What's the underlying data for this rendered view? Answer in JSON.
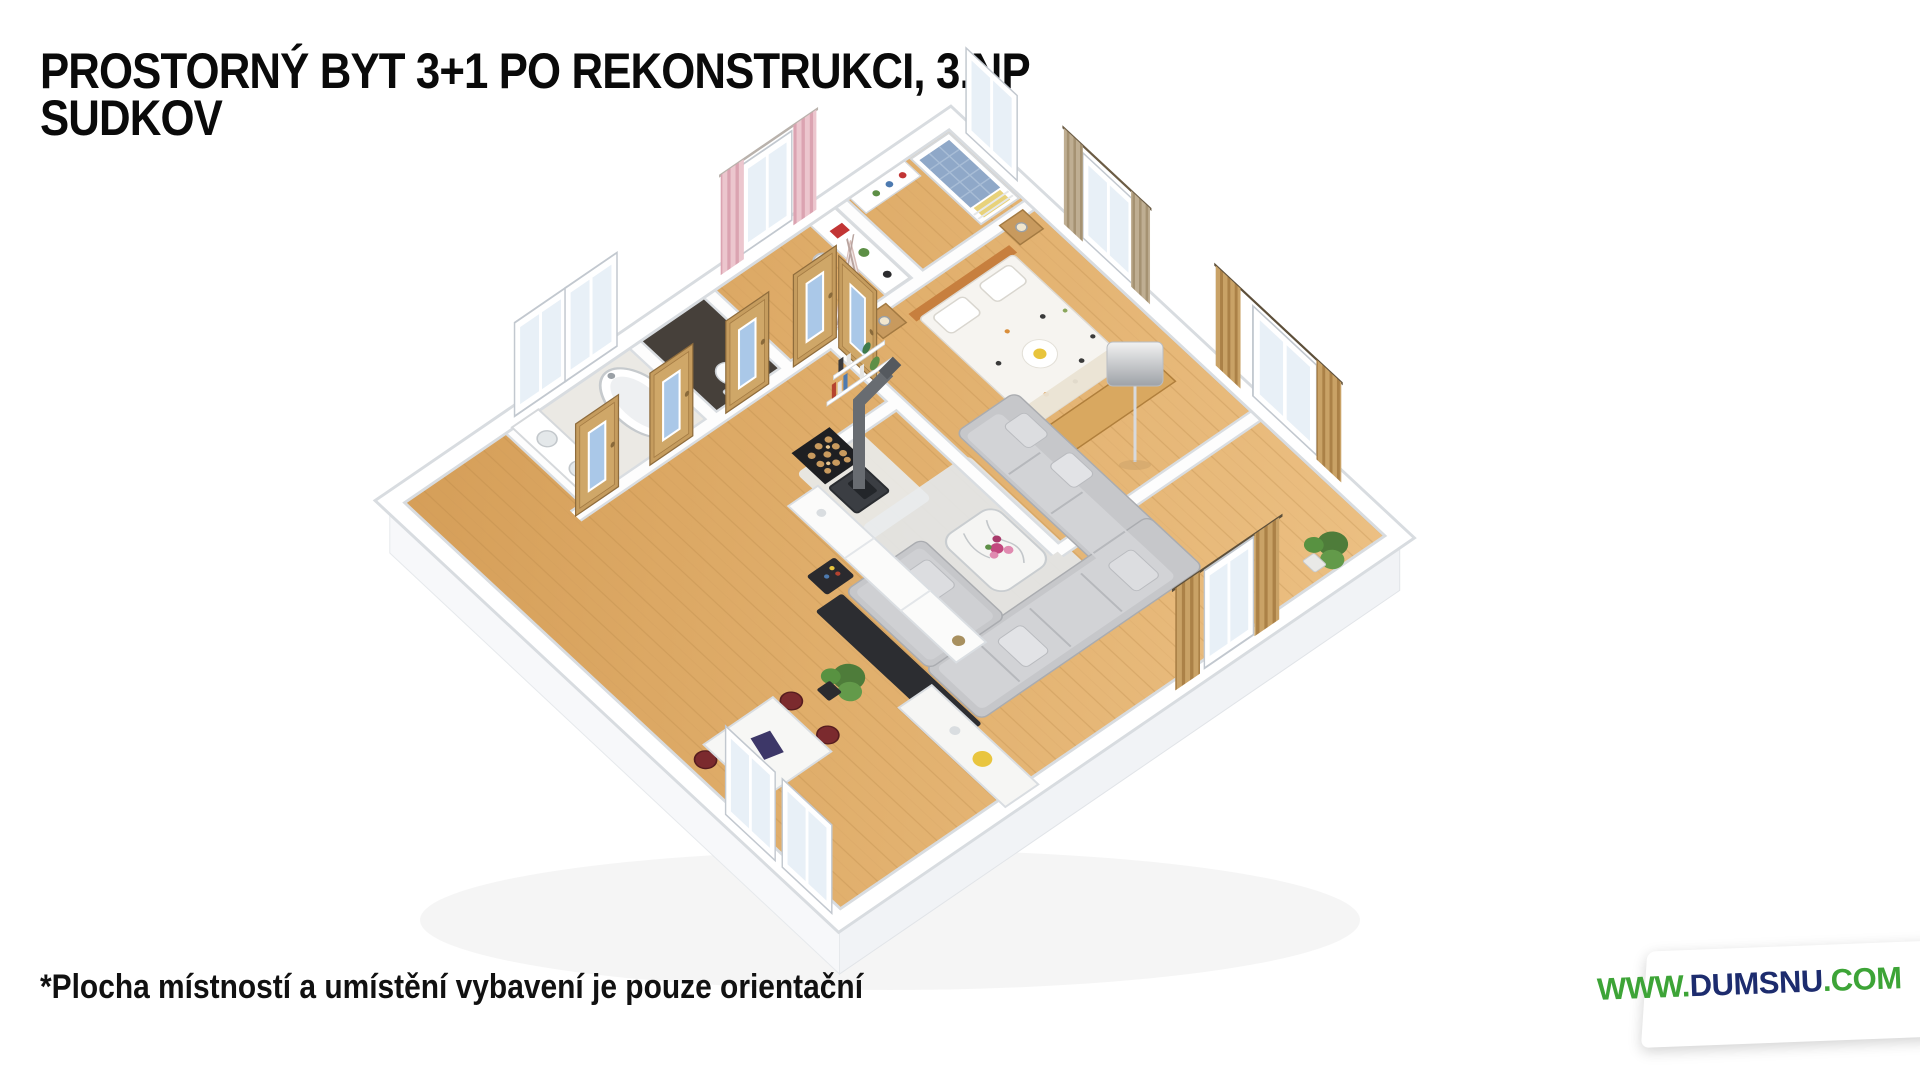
{
  "title": {
    "line1": "PROSTORNÝ BYT 3+1 PO REKONSTRUKCI, 3.NP",
    "line2": "SUDKOV"
  },
  "disclaimer": "*Plocha místností a umístění vybavení je pouze orientační",
  "watermark": {
    "prefix": "WWW.",
    "name": "DUMSNU",
    "suffix": ".COM",
    "prefix_color": "#3da437",
    "name_color": "#1d2c6e",
    "suffix_color": "#3da437",
    "background": "#ffffff"
  },
  "colors": {
    "headline_text": "#0a0a0a",
    "wood_floor": "#e0ae6b",
    "bathroom_floor": "#ebe9e4",
    "wc_floor": "#46403a",
    "walls": "#ffffff",
    "wall_edge": "#d8dce0",
    "sofa": "#c6c7ca",
    "door_wood": "#c59c5e",
    "door_glass": "#aac8e8",
    "curtain_pink": "#ecc6ce",
    "curtain_gold": "#c9a266",
    "curtain_tan": "#bfae92",
    "headboard_orange": "#c77f3e"
  },
  "scene": {
    "type": "3d-floorplan-render",
    "rooms": [
      "bunk-room",
      "children-room",
      "wc",
      "bathroom",
      "hallway",
      "master-bedroom",
      "living-room",
      "dining-kitchen"
    ],
    "elements": [
      "bathtub",
      "vanity-sinks",
      "toilet",
      "bunk-bed",
      "kids-desk",
      "teepee",
      "double-bed",
      "nightstands",
      "wood-dresser",
      "corner-sofa",
      "coffee-table-flowers",
      "floor-lamp",
      "wall-shelves",
      "wood-stove",
      "firewood-rack",
      "white-sideboard",
      "bar-cart",
      "dining-table",
      "red-chairs",
      "laptop",
      "kitchen-counter",
      "fruit-bowl",
      "potted-plants",
      "wooden-doors-blue-glass",
      "windows",
      "pink-curtains",
      "gold-curtains",
      "tan-curtains"
    ]
  }
}
